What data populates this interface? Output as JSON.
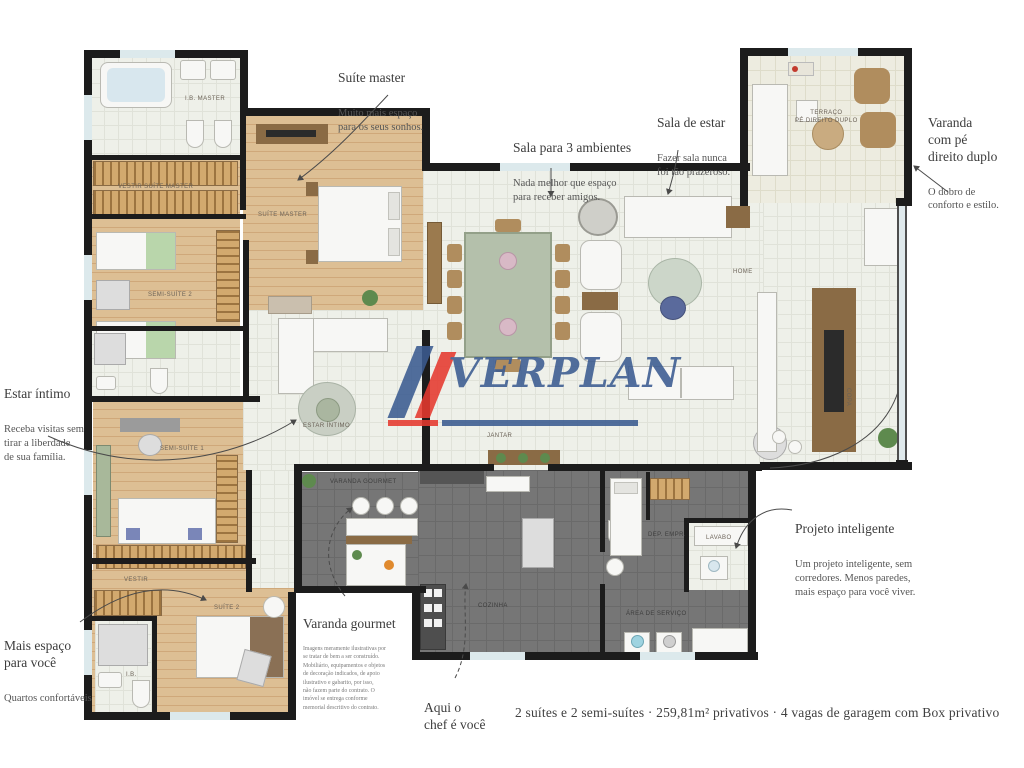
{
  "brand": {
    "name": "VERPLAN",
    "blue": "#3b5b91",
    "red": "#e6392f"
  },
  "annotations": {
    "suite_master": {
      "title": "Suíte master",
      "body": "Muito mais espaço\npara os seus sonhos."
    },
    "sala_3_ambientes": {
      "title": "Sala para 3 ambientes",
      "body": "Nada melhor que espaço\npara receber amigos."
    },
    "sala_de_estar": {
      "title": "Sala de estar",
      "body": "Fazer sala nunca\nfoi tão prazeroso."
    },
    "varanda_pe_direito": {
      "title": "Varanda\ncom pé\ndireito duplo",
      "body": "O dobro de\nconforto e estilo."
    },
    "estar_intimo": {
      "title": "Estar íntimo",
      "body": "Receba visitas sem\ntirar a liberdade\nde sua família."
    },
    "mais_espaco": {
      "title": "Mais espaço\npara você",
      "body": "Quartos confortáveis"
    },
    "projeto_inteligente": {
      "title": "Projeto inteligente",
      "body": "Um projeto inteligente, sem\ncorredores. Menos paredes,\nmais espaço para você viver."
    },
    "varanda_gourmet": {
      "title": "Varanda gourmet"
    },
    "chef": {
      "title": "Aqui o\nchef é você"
    },
    "disclaimer": "Imagens meramente ilustrativas por\nse tratar de bem a ser construído.\nMobiliário, equipamentos e objetos\nde decoração indicados, de apoio\nilustrativo e gabarito, por isso,\nnão fazem parte do contrato. O\nimóvel se entrega conforme\nmemorial descritivo do contrato."
  },
  "footer": {
    "caption": "2 suítes e 2 semi-suítes · 259,81m² privativos · 4 vagas de garagem com Box privativo"
  },
  "rooms": {
    "ib_master": "I.B. MASTER",
    "vestir_master": "VESTIR SUÍTE MASTER",
    "semi_suite_2": "SEMI-SUÍTE 2",
    "semi_suite_1": "SEMI-SUÍTE 1",
    "vestir": "VESTIR",
    "suite_2": "SUÍTE 2",
    "ib": "I.B.",
    "suite_master": "SUÍTE MASTER",
    "estar_intimo": "ESTAR ÍNTIMO",
    "jantar": "JANTAR",
    "home": "HOME",
    "terraco": "TERRAÇO\nPÉ DIREITO DUPLO",
    "copa": "COPA",
    "varanda_gourmet": "VARANDA GOURMET",
    "cozinha": "COZINHA",
    "dep_empr": "DEP. EMPR.",
    "lavabo": "LAVABO",
    "area_servico": "ÁREA DE SERVIÇO"
  }
}
